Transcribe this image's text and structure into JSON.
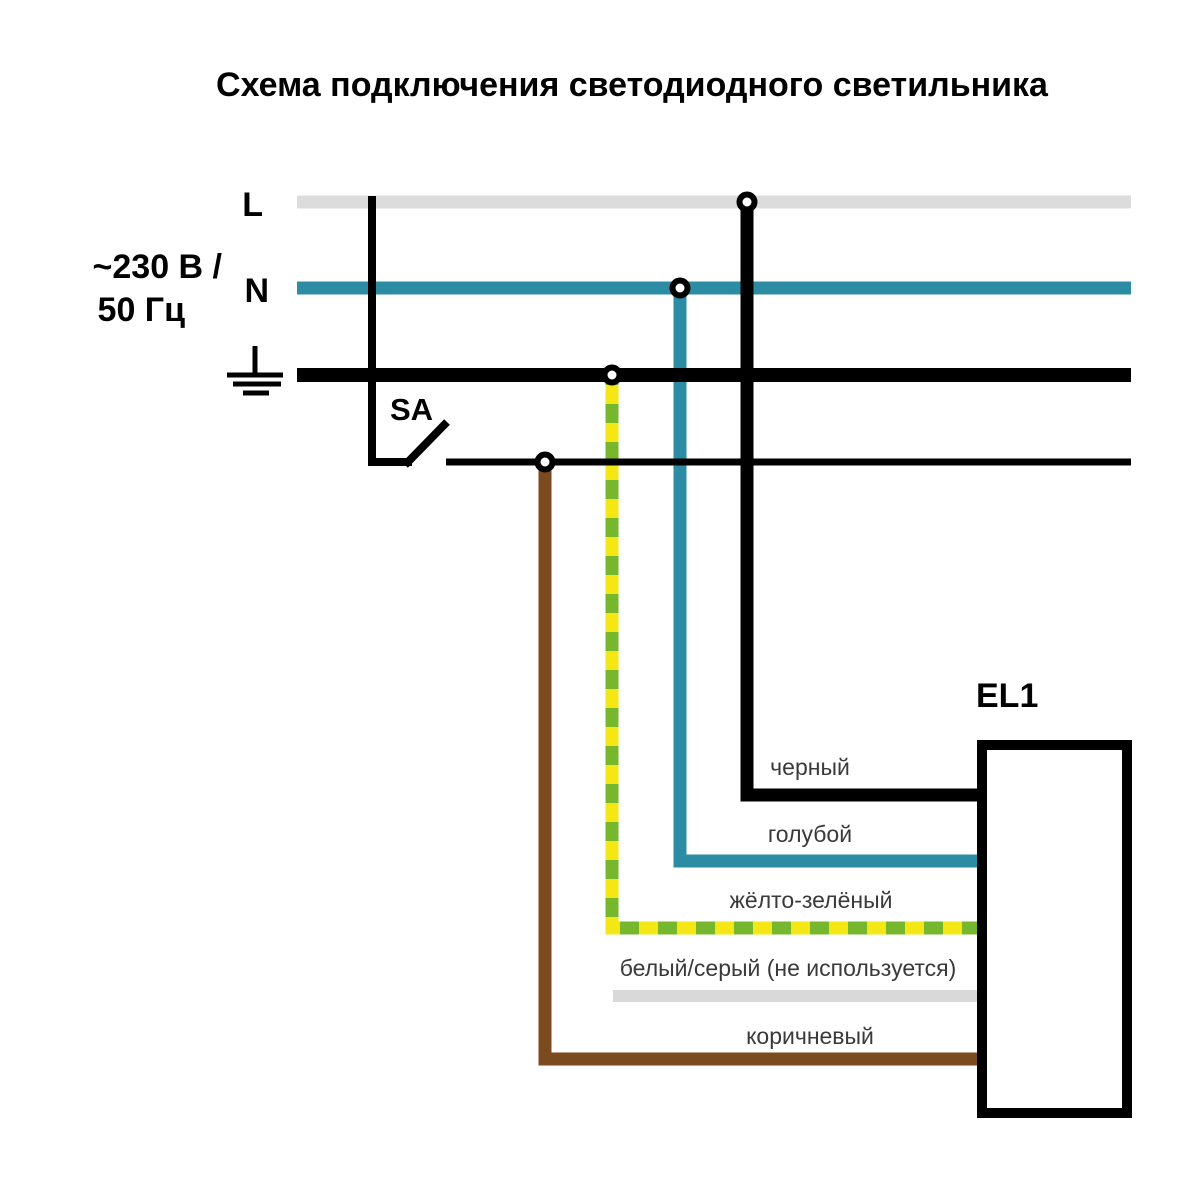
{
  "title": "Схема подключения светодиодного светильника",
  "power": {
    "voltage_line1": "~230 В /",
    "voltage_line2": "50 Гц",
    "line_label": "L",
    "neutral_label": "N"
  },
  "switch": {
    "label": "SA"
  },
  "luminaire": {
    "label": "EL1"
  },
  "wire_labels": {
    "black": "черный",
    "blue": "голубой",
    "yellow_green": "жёлто-зелёный",
    "white_gray": "белый/серый (не используется)",
    "brown": "коричневый"
  },
  "colors": {
    "l_bus_gray": "#dcdcdc",
    "neutral_teal": "#2b8ca3",
    "black": "#000000",
    "pe_yellow": "#f5e616",
    "pe_green": "#76b72e",
    "brown": "#7c4a1f",
    "unused_gray": "#d9d9d9",
    "label_text": "#3a3a3a"
  }
}
